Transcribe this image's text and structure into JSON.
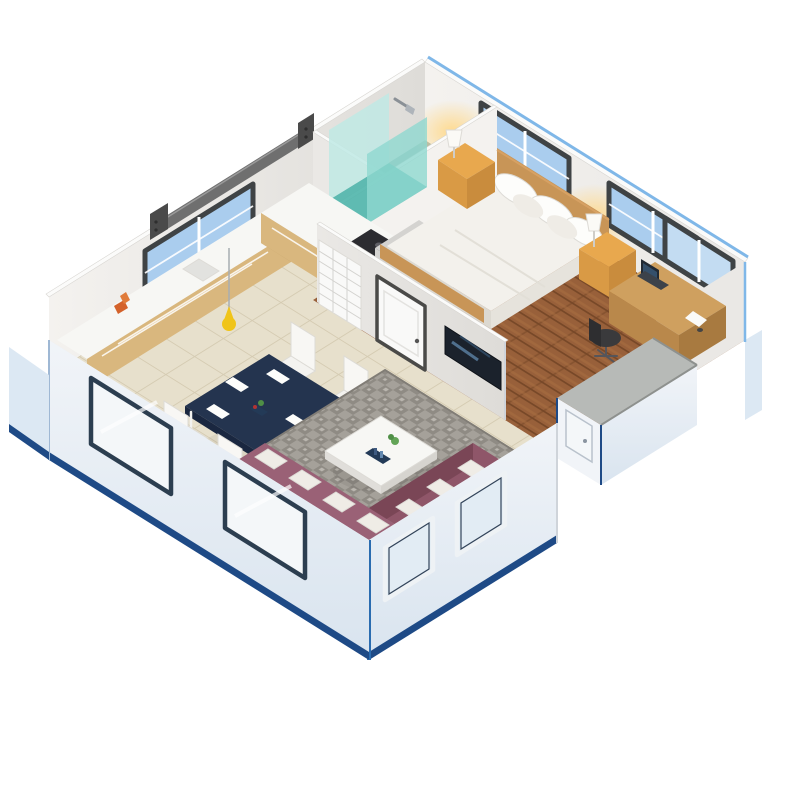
{
  "image": {
    "kind": "3d-isometric-floor-plan-render",
    "description": "Isometric cutaway render of a small expandable container house with one bedroom, bathroom with teal glass shower, open kitchen with L-shaped counter, navy dining table with four white chairs, and living area with plum sofa, gray mosaic rug, white coffee table and wall TV. White walls with blue-trimmed exterior panels on a plain white background.",
    "background": "#ffffff"
  },
  "palette": {
    "bg": "#ffffff",
    "wallLit": "#f4f2ef",
    "wallMid": "#eae8e5",
    "wallShade": "#dedcd8",
    "wallCap": "#fbfbfa",
    "edgeBlue": "#7fb7e8",
    "trimNavy": "#1e4a86",
    "extLight": "#f1f4f8",
    "extShade": "#d9e4ef",
    "extStrip": "#dce8f3",
    "floorTile": "#e7e0cc",
    "tileLine": "#d5cbb2",
    "woodBase": "#98603a",
    "woodDark": "#774828",
    "woodLight": "#aa6f42",
    "bathFloor": "#9db3b0",
    "rugA": "#a5a19a",
    "rugB": "#8f8b84",
    "rugSpeck": "#bab6af",
    "rugEdge": "#817d76",
    "counterWood": "#d9b77e",
    "counterWoodEnd": "#c9a86e",
    "counterTop": "#f7f7f4",
    "cabinetGray": "#d4d3d0",
    "cabinetGraySide": "#c6c5c2",
    "stoveDark": "#2c2c30",
    "burnerGray": "#606066",
    "sinkGray": "#e2e2df",
    "tableNavy": "#24344f",
    "tableNavyDark": "#1a2740",
    "chairWhite": "#f4f3f0",
    "chairWhiteLit": "#f8f7f4",
    "plateWhite": "#fdfdfb",
    "sofaPlum": "#8f5669",
    "sofaPlumLit": "#9a6176",
    "sofaPlumDark": "#7a4656",
    "cushionWhite": "#efece6",
    "bedWhite": "#f3f1ec",
    "bedShadow": "#dcd9d1",
    "bedSide": "#e6e3dc",
    "headboardWood": "#c89557",
    "nightstand": "#e8a84e",
    "nightstandFront": "#d99a45",
    "nightstandDark": "#c98c3d",
    "lampWhite": "#fbfaf6",
    "lampGlow": "#ffd98a",
    "doorFrame": "#4a4a48",
    "doorWhite": "#f9f9f8",
    "tvDark": "#1b222c",
    "tvStreak": "#5d83a6",
    "tvStreak2": "#3c5f80",
    "showerTeal": "#8fd8d0",
    "showerPale": "#bfe9e4",
    "showerDeep": "#4fb5ab",
    "beamGray": "#6f6f6f",
    "beamDark": "#4a4a4a",
    "deskWood": "#cfa05f",
    "deskWoodFront": "#b9884b",
    "deskWoodSide": "#a87a40",
    "laptopDark": "#222a34",
    "laptopScreen": "#35506b",
    "laptopBase": "#3c424a",
    "chairDark": "#3a3a3c",
    "chairDarkBack": "#2e2e30",
    "glassBlue": "#aacdee",
    "glassBlueLight": "#c3dcf2",
    "glassPale": "#e2ecf4",
    "glassWhite": "#f4f7f9",
    "frameDark": "#3f4345",
    "frameNavy": "#2c3e50",
    "frameWhite": "#eef2f5",
    "plantGreen": "#4f8f46",
    "plantDark": "#3f7a38",
    "plantLight": "#63a457",
    "potBrown": "#b9835a",
    "pendantYellow": "#f0c419",
    "pendantEdge": "#cfa300",
    "accentOrange": "#d4622a",
    "accentOrangeLight": "#e07b3a",
    "porchGray": "#b7bab7",
    "porchRail": "#8e918e",
    "ottomanDark": "#4b4a48",
    "ottomanLit": "#6a6967",
    "paperWhite": "#fafaf8",
    "trayNavy": "#233a57"
  },
  "scene": {
    "rooms": [
      {
        "name": "bedroom",
        "floor": "wood-planks"
      },
      {
        "name": "bathroom",
        "floor": "dark-tile",
        "fixtures": [
          "corner-shower-teal-glass",
          "shower-head"
        ]
      },
      {
        "name": "kitchen",
        "floor": "beige-tile",
        "fixtures": [
          "l-shaped-counter",
          "cooktop",
          "sink",
          "tall-cabinet",
          "pendant-lamp"
        ]
      },
      {
        "name": "dining-area",
        "floor": "beige-tile"
      },
      {
        "name": "living-room",
        "floor": "beige-tile-with-rug"
      }
    ],
    "furniture": {
      "bedroom": [
        "double-bed-white",
        "wood-headboard",
        "nightstand-left",
        "nightstand-right",
        "table-lamp-left",
        "table-lamp-right",
        "desk",
        "laptop",
        "office-chair"
      ],
      "dining": [
        "navy-dining-table",
        "white-chair-1",
        "white-chair-2",
        "white-chair-3",
        "white-chair-4",
        "potted-plant"
      ],
      "living": [
        "plum-sectional-sofa",
        "white-cushions",
        "gray-mosaic-rug",
        "white-coffee-table",
        "wall-tv",
        "ottoman"
      ]
    },
    "openings": {
      "windows": [
        "bedroom-window-1",
        "bedroom-window-2",
        "bedroom-window-3",
        "kitchen-window",
        "front-left-window-1",
        "front-left-window-2",
        "front-right-window-1",
        "front-right-window-2"
      ],
      "doors": [
        "bedroom-white-door",
        "bathroom-louver-door",
        "porch-panel-door"
      ]
    },
    "structure": [
      "roof-beam-rail",
      "expanded-porch-box",
      "blue-trimmed-exterior-panels"
    ]
  }
}
